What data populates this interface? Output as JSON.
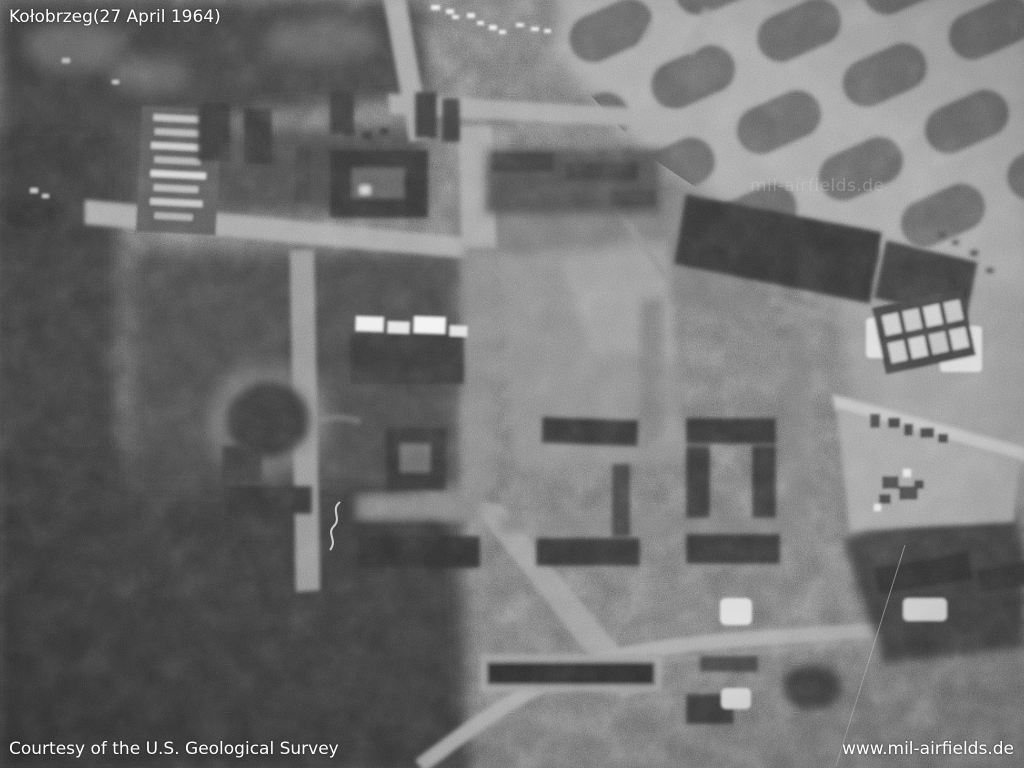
{
  "overlays": {
    "title": "Kołobrzeg(27 April 1964)",
    "credit": "Courtesy of the U.S. Geological Survey",
    "website": "www.mil-airfields.de",
    "watermark": "mil-airfields.de"
  },
  "photo": {
    "type": "black-and-white aerial photograph",
    "subject": "aerial view of Kołobrzeg, 27 April 1964",
    "palette": {
      "base_gray": "#474747",
      "dark_gray": "#2d2d2d",
      "light_gray": "#9c9c9c",
      "text_white": "#ffffff"
    }
  }
}
